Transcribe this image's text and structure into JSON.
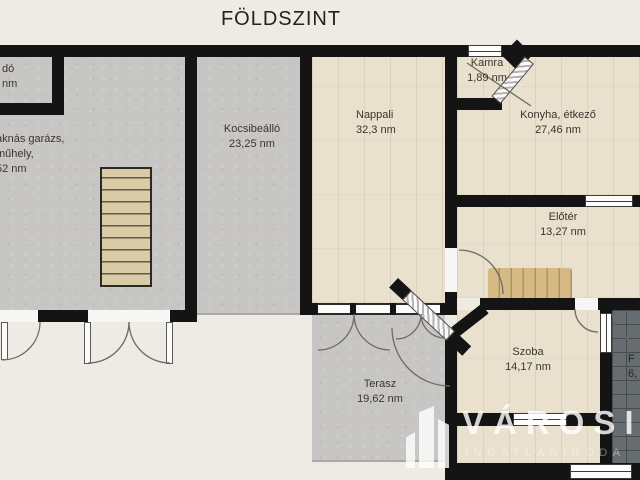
{
  "title": "FÖLDSZINT",
  "rooms": {
    "small_room": {
      "line1": "dó",
      "line2": "nm"
    },
    "garage": {
      "line1": "aknás garázs,",
      "line2": "műhely,",
      "line3": "52 nm"
    },
    "kocsibeallo": {
      "name": "Kocsibeálló",
      "area": "23,25 nm"
    },
    "nappali": {
      "name": "Nappali",
      "area": "32,3 nm"
    },
    "konyha": {
      "name": "Konyha, étkező",
      "area": "27,46 nm"
    },
    "kamra": {
      "name": "Kamra",
      "area": "1,89 nm"
    },
    "eloter": {
      "name": "Előtér",
      "area": "13,27 nm"
    },
    "szoba": {
      "name": "Szoba",
      "area": "14,17 nm"
    },
    "terasz": {
      "name": "Terasz",
      "area": "19,62 nm"
    },
    "furdo": {
      "name": "F",
      "area": "6,"
    }
  },
  "watermark": {
    "brand": "VÁROSI",
    "subtitle": "INGATLANIRODA"
  },
  "colors": {
    "wall": "#141414",
    "concrete_floor": "#c7c6c4",
    "wood_floor": "#e9e1ce",
    "tile_floor": "#666c6f",
    "stairs": "#d9cba6",
    "background": "#eeebe5",
    "watermark_text": "#ffffff"
  }
}
